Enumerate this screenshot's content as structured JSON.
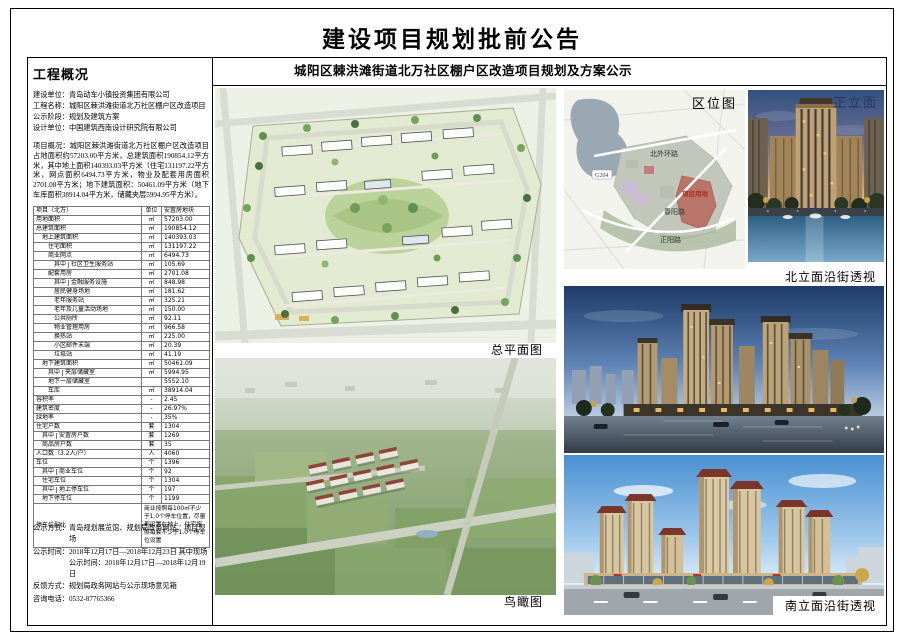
{
  "page": {
    "title": "建设项目规划批前公告"
  },
  "left_panel": {
    "heading": "工程概况",
    "info_lines": [
      {
        "label": "建设单位：",
        "value": "青岛动车小镇投资集团有限公司"
      },
      {
        "label": "工程名称：",
        "value": "城阳区棘洪滩街道北万社区棚户区改造项目"
      },
      {
        "label": "公示阶段：",
        "value": "规划及建筑方案"
      },
      {
        "label": "设计单位：",
        "value": "中国建筑西南设计研究院有限公司"
      }
    ],
    "overview_label": "项目概况：",
    "overview_text": "城阳区棘洪滩街道北万社区棚户区改造项目占地面积约57203.00平方米，总建筑面积190854.12平方米，其中地上面积140393.03平方米（住宅131197.22平方米，网点面积6494.73平方米，物业及配套用房面积2701.08平方米；地下建筑面积：50461.09平方米（地下车库面积38914.04平方米，储藏夹层5994.95平方米）。",
    "table": {
      "headers": [
        "项目（北万）",
        "单位",
        "安置房地块"
      ],
      "rows": [
        {
          "indent": 0,
          "label": "用地面积",
          "unit": "㎡",
          "value": "57203.00"
        },
        {
          "indent": 0,
          "label": "总建筑面积",
          "unit": "㎡",
          "value": "190854.12"
        },
        {
          "indent": 1,
          "label": "地上建筑面积",
          "unit": "㎡",
          "value": "140393.03"
        },
        {
          "indent": 2,
          "label": "住宅面积",
          "unit": "㎡",
          "value": "131197.22"
        },
        {
          "indent": 2,
          "label": "商业网点",
          "unit": "㎡",
          "value": "6494.73"
        },
        {
          "indent": 3,
          "qz": "其中",
          "label": "社区卫生服务站",
          "unit": "㎡",
          "value": "105.69"
        },
        {
          "indent": 2,
          "label": "配套用房",
          "unit": "㎡",
          "value": "2701.08"
        },
        {
          "indent": 3,
          "qz": "其中",
          "label": "金融服务设施",
          "unit": "㎡",
          "value": "848.98"
        },
        {
          "indent": 3,
          "label": "居民健身场地",
          "unit": "㎡",
          "value": "181.62"
        },
        {
          "indent": 3,
          "label": "老年服务站",
          "unit": "㎡",
          "value": "325.21"
        },
        {
          "indent": 3,
          "label": "老年及儿童活动场地",
          "unit": "㎡",
          "value": "150.00"
        },
        {
          "indent": 3,
          "label": "公共厕所",
          "unit": "㎡",
          "value": "92.11"
        },
        {
          "indent": 3,
          "label": "物业管理用房",
          "unit": "㎡",
          "value": "966.58"
        },
        {
          "indent": 3,
          "label": "换热站",
          "unit": "㎡",
          "value": "225.00"
        },
        {
          "indent": 3,
          "label": "小区邮件末端",
          "unit": "㎡",
          "value": "20.39"
        },
        {
          "indent": 3,
          "label": "垃圾站",
          "unit": "㎡",
          "value": "41.19"
        },
        {
          "indent": 1,
          "label": "地下建筑面积",
          "unit": "㎡",
          "value": "50461.09"
        },
        {
          "indent": 2,
          "qz": "其中",
          "label": "夹层储藏室",
          "unit": "㎡",
          "value": "5994.95"
        },
        {
          "indent": 2,
          "label": "地下一层储藏室",
          "unit": "",
          "value": "5552.10"
        },
        {
          "indent": 2,
          "label": "车库",
          "unit": "㎡",
          "value": "38914.04"
        },
        {
          "indent": 0,
          "label": "容积率",
          "unit": "-",
          "value": "2.45"
        },
        {
          "indent": 0,
          "label": "建筑密度",
          "unit": "-",
          "value": "26.97%"
        },
        {
          "indent": 0,
          "label": "绿地率",
          "unit": "-",
          "value": "35%"
        },
        {
          "indent": 0,
          "label": "住宅户数",
          "unit": "套",
          "value": "1304"
        },
        {
          "indent": 1,
          "qz": "其中",
          "label": "安置房户数",
          "unit": "套",
          "value": "1269"
        },
        {
          "indent": 1,
          "label": "商品房户数",
          "unit": "套",
          "value": "35"
        },
        {
          "indent": 0,
          "label": "人口数（3.2人/户）",
          "unit": "人",
          "value": "4060"
        },
        {
          "indent": 0,
          "label": "车位",
          "unit": "个",
          "value": "1396"
        },
        {
          "indent": 1,
          "qz": "其中",
          "label": "商业车位",
          "unit": "个",
          "value": "92"
        },
        {
          "indent": 1,
          "label": "住宅车位",
          "unit": "个",
          "value": "1304"
        },
        {
          "indent": 1,
          "qz": "其中",
          "label": "地上停车位",
          "unit": "个",
          "value": "197"
        },
        {
          "indent": 1,
          "label": "地下停车位",
          "unit": "个",
          "value": "1199"
        },
        {
          "indent": 0,
          "label": "停车位配比",
          "tall": true,
          "value": "商业按照每100㎡不少于1.0个停车位置，尽量都设置在地上，住宅按照每套不少于1.0个停车位设置"
        }
      ]
    },
    "notices": [
      {
        "label": "公示方式：",
        "value": "青岛规划展览馆、规划局政务网站、项目现场"
      },
      {
        "label": "公示时间：",
        "value": "2018年12月17日—2018年12月23日 其中现场公示时间：2018年12月17日—2018年12月19日"
      },
      {
        "label": "反馈方式：",
        "value": "规划局政务网站与公示现场意见箱"
      },
      {
        "label": "咨询电话：",
        "value": "0532-87765366"
      }
    ]
  },
  "right_region": {
    "subtitle": "城阳区棘洪滩街道北万社区棚户区改造项目规划及方案公示",
    "labels": {
      "site_plan": "总平面图",
      "birdseye": "鸟瞰图",
      "location_map": "区位图",
      "front_elevation": "正立面",
      "north_perspective": "北立面沿街透视",
      "south_perspective": "南立面沿街透视"
    },
    "map_labels": {
      "road_north": "北外环路",
      "road_g204": "G204",
      "road_chunyang": "春阳路",
      "road_zhengyang": "正阳路",
      "site_marker": "项目用地",
      "site_marker_color": "#b42a20"
    }
  }
}
